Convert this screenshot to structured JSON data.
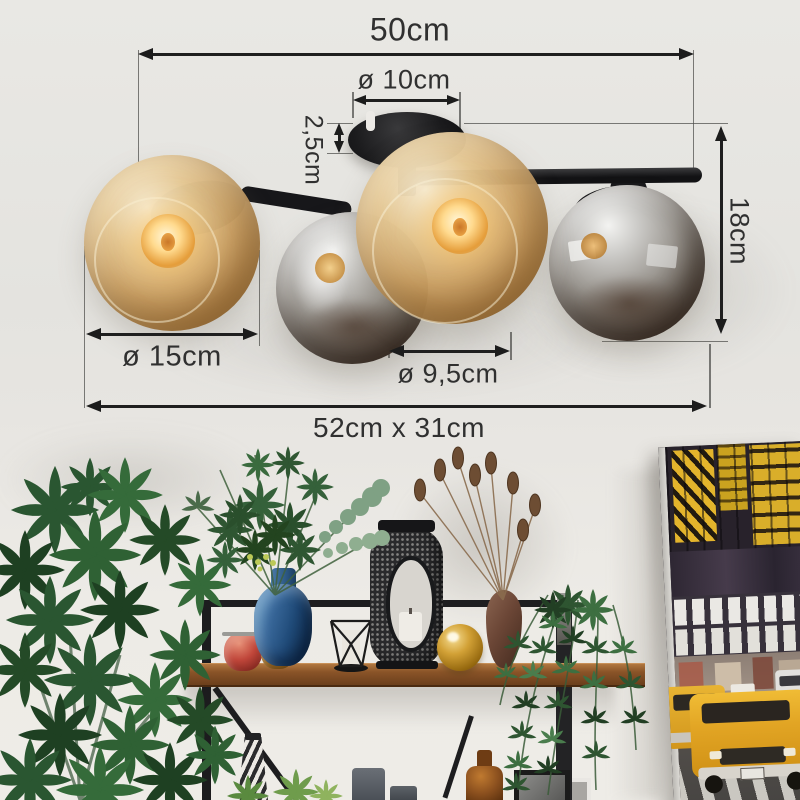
{
  "dimensions": {
    "width_top": "50cm",
    "canopy_diameter": "ø 10cm",
    "canopy_height": "2,5cm",
    "fixture_height": "18cm",
    "large_globe_diameter": "ø 15cm",
    "small_globe_diameter": "ø 9,5cm",
    "overall_size": "52cm x 31cm"
  },
  "colors": {
    "annotation_line": "#1c1c1c",
    "annotation_text": "#303030",
    "lamp_black": "#17171a",
    "amber_glass": "#cda263",
    "chrome_glass": "#9d9993",
    "ceiling": "#e8e7e3",
    "wall": "#edebe6",
    "wood_shelf": "#8a5a30",
    "blue_vase": "#2e5f93",
    "red_jar": "#b5443a",
    "amber_jar": "#a06a28",
    "gold_ball": "#c9972c",
    "brown_vase": "#6b4a38",
    "plant_green": "#2b5631",
    "canvas_taxi_yellow": "#e2a524"
  }
}
